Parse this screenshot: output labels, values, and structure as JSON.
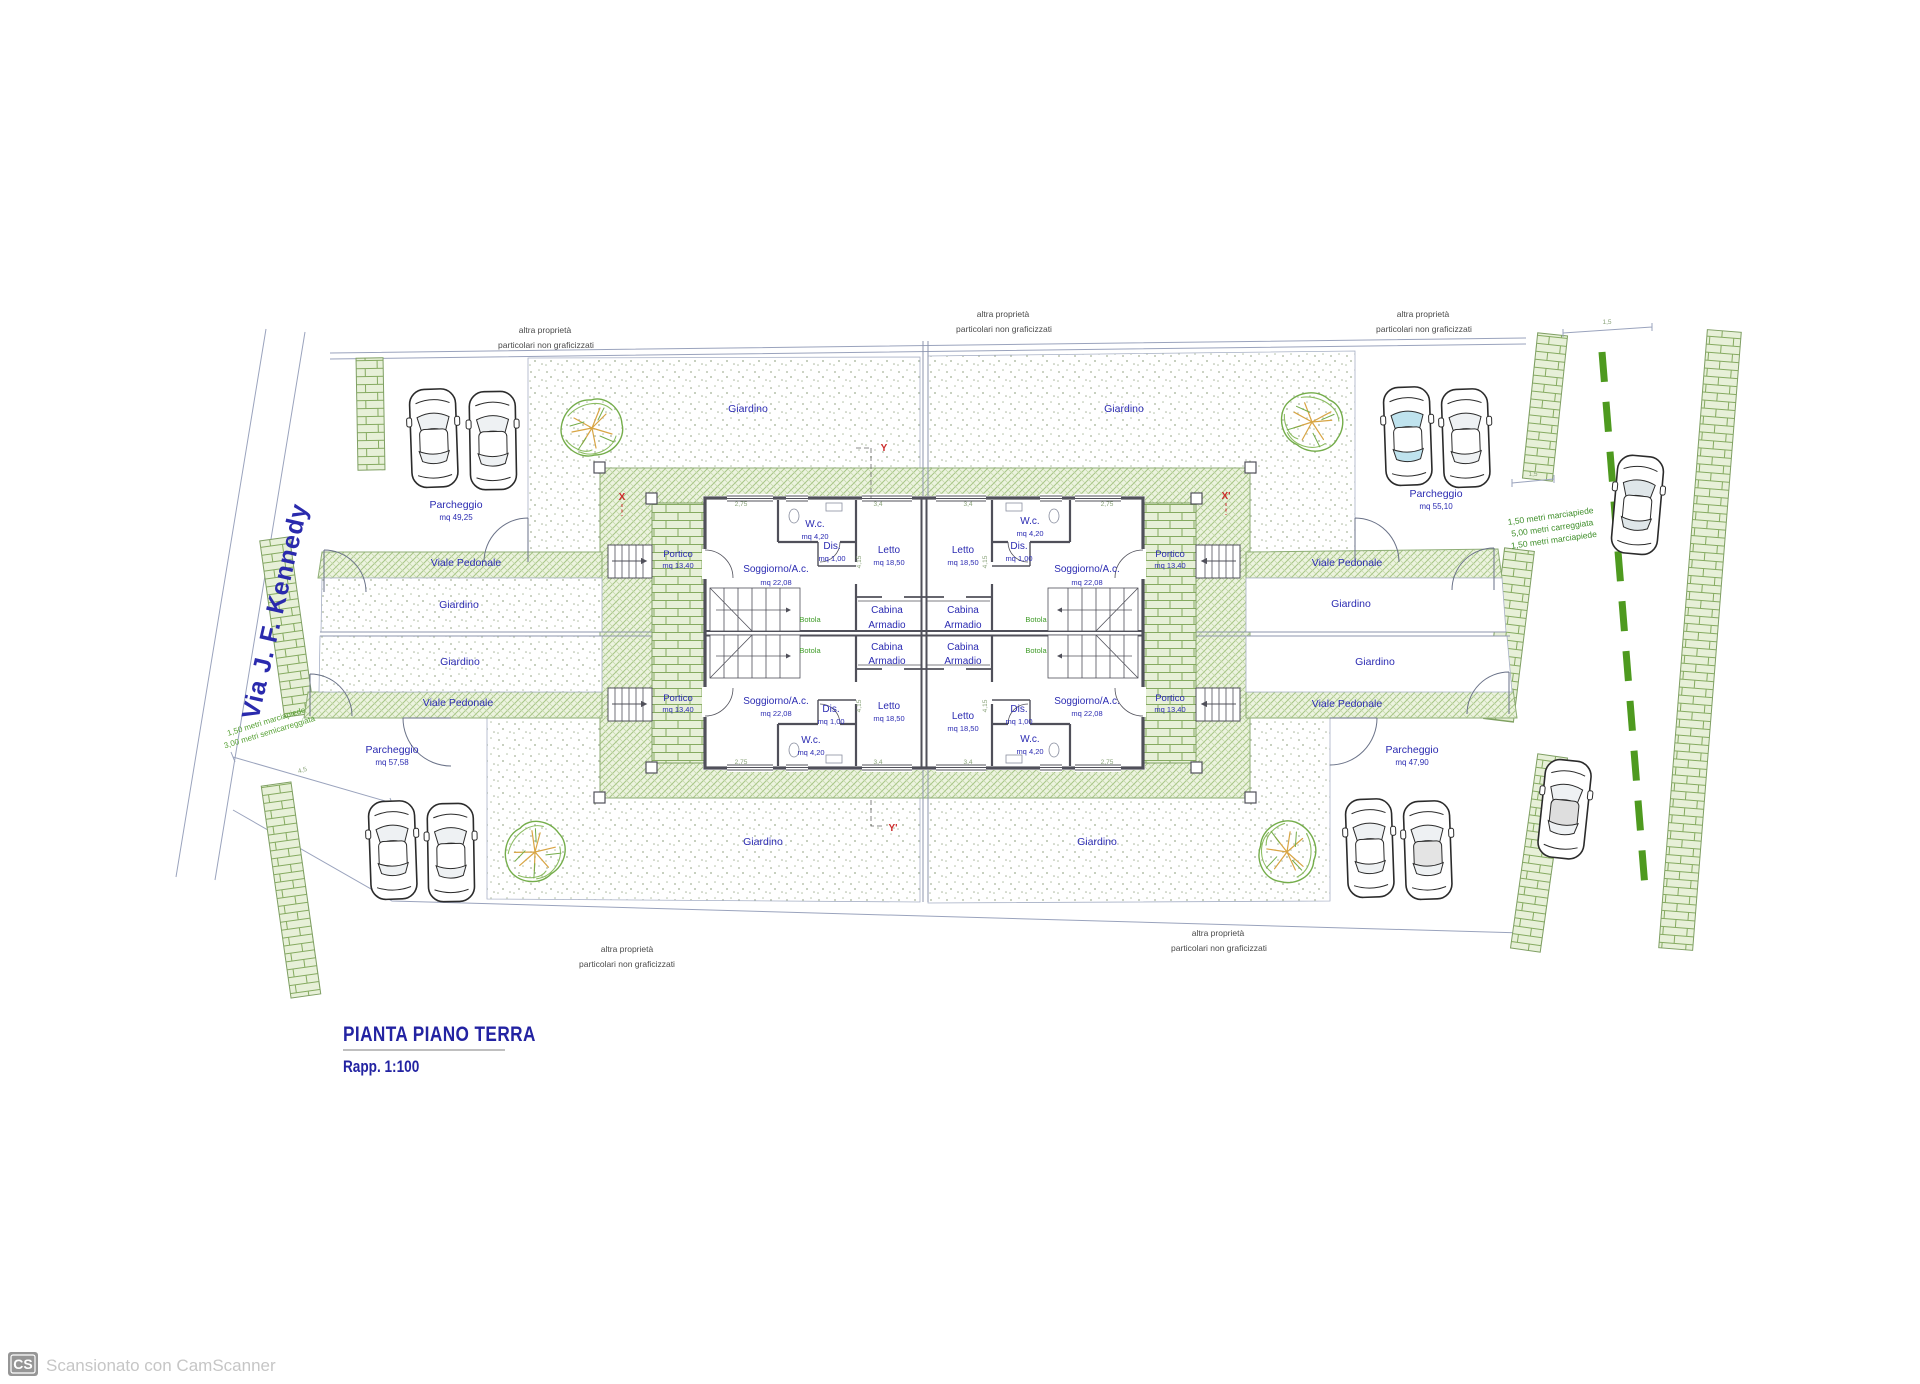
{
  "document": {
    "title": "PIANTA PIANO TERRA",
    "scale": "Rapp. 1:100",
    "watermark_badge": "CS",
    "watermark_text": "Scansionato con CamScanner"
  },
  "street": {
    "name": "Via J. F. Kennedy"
  },
  "boundary_note": {
    "line1": "altra proprietà",
    "line2": "particolari non graficizzati"
  },
  "road_sections": {
    "right_line1": "1,50 metri marciapiede",
    "right_line2": "5,00 metri carreggiata",
    "right_line3": "1,50 metri marciapiede",
    "left_line1": "1,50 metri marciapiede",
    "left_line2": "3,00 metri semicarreggiata"
  },
  "site": {
    "garden": "Giardino",
    "walkway": "Viale Pedonale",
    "parking": "Parcheggio",
    "parking_areas": {
      "top_left": "mq 49,25",
      "top_right": "mq 55,10",
      "bottom_left": "mq 57,58",
      "bottom_right": "mq 47,90"
    },
    "portico": "Portico",
    "portico_area": "mq 13,40"
  },
  "rooms": {
    "soggiorno": "Soggiorno/A.c.",
    "soggiorno_area": "mq 22,08",
    "letto": "Letto",
    "letto_area": "mq 18,50",
    "wc": "W.c.",
    "wc_area": "mq 4,20",
    "dis": "Dis.",
    "dis_area": "mq 1,00",
    "cabina_line1": "Cabina",
    "cabina_line2": "Armadio",
    "botola": "Botola"
  },
  "markers": {
    "x": "X",
    "x_prime": "X'",
    "y": "Y",
    "y_prime": "Y'"
  },
  "dims": {
    "d1": "3,4",
    "d2": "4,15",
    "d3": "2,75",
    "d4": "1,5",
    "d5": "4,5"
  },
  "colors": {
    "label_blue": "#2b2bb2",
    "note_green": "#3f8f2a",
    "marker_red": "#cc2b2b",
    "hatch_green": "#a8c687",
    "brick_green": "#85aa60",
    "wall_gray": "#50505a"
  }
}
